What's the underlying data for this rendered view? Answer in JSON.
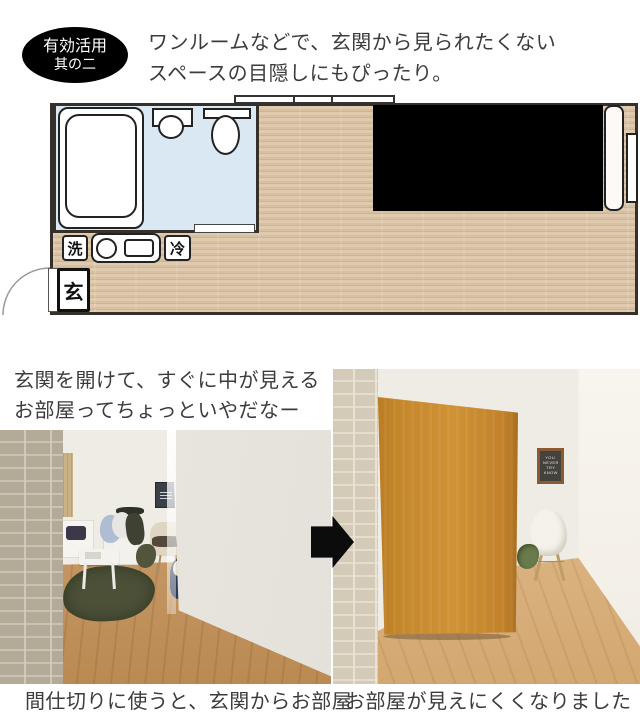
{
  "badge": {
    "line1": "有効活用",
    "line2": "其の二"
  },
  "headline": {
    "line1": "ワンルームなどで、玄関から見られたくない",
    "line2": "スペースの目隠しにもぴったり。"
  },
  "floorplan": {
    "labels": {
      "washer": "洗",
      "fridge": "冷",
      "entrance": "玄"
    }
  },
  "midtext": {
    "line1": "玄関を開けて、すぐに中が見える",
    "line2": "お部屋ってちょっといやだなー"
  },
  "captions": {
    "before": "間仕切りに使うと、玄関からお部屋",
    "after": "お部屋が見えにくくなりました"
  },
  "poster": {
    "lines": [
      "YOU",
      "NEVER",
      "TRY",
      "KNOW"
    ]
  },
  "colors": {
    "text": "#3c3c3c",
    "badge_bg": "#000000",
    "badge_text": "#ffffff",
    "wall": "#36302a",
    "bathroom": "#dae8f3",
    "hidden_area": "#000000",
    "rug": "#4b5037",
    "partition": "#c5872b",
    "arrow": "#0c0c0c",
    "brick_before": "#b4aa98",
    "brick_after": "#d3cab8"
  }
}
